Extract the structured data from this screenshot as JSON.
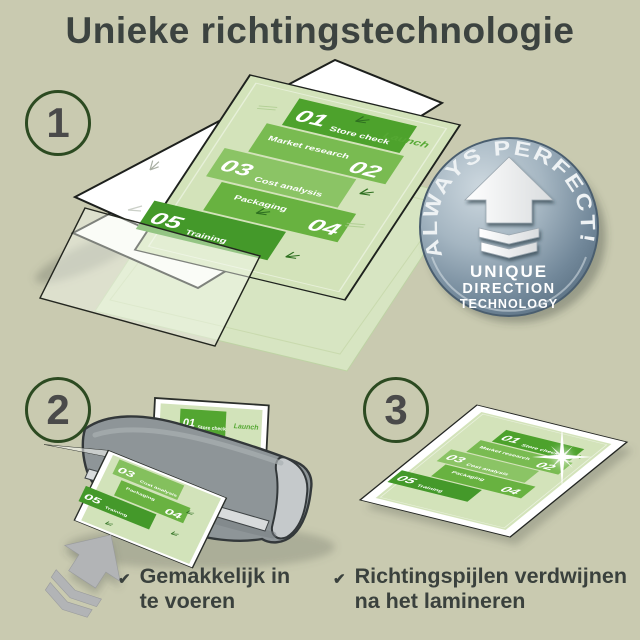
{
  "title": "Unieke richtingstechnologie",
  "steps": {
    "one": "1",
    "two": "2",
    "three": "3"
  },
  "badge": {
    "arc": "ALWAYS PERFECT!",
    "line1": "UNIQUE",
    "line2": "DIRECTION",
    "line3": "TECHNOLOGY"
  },
  "doc": {
    "launch": "Launch",
    "sections": [
      {
        "num": "01",
        "label": "Store check"
      },
      {
        "num": "02",
        "label": "Market research"
      },
      {
        "num": "03",
        "label": "Cost analysis"
      },
      {
        "num": "04",
        "label": "Packaging"
      },
      {
        "num": "05",
        "label": "Training"
      }
    ]
  },
  "benefits": [
    {
      "icon": "✔",
      "line1": "Gemakkelijk in",
      "line2": "te voeren"
    },
    {
      "icon": "✔",
      "line1": "Richtingspijlen verdwijnen",
      "line2": "na het lamineren"
    }
  ],
  "colors": {
    "background": "#c9cab0",
    "title_text": "#3c4340",
    "step_circle_green": "#2c4a21",
    "doc_light_green": "#d3e3ba",
    "block_green_dark": "#4da22c",
    "block_green_mid": "#68b240",
    "block_green_light": "#8bc465",
    "badge_blue_gray": "#72889a",
    "laminator_gray": "#8e9598",
    "arrow_gray": "#b2b4b6"
  }
}
